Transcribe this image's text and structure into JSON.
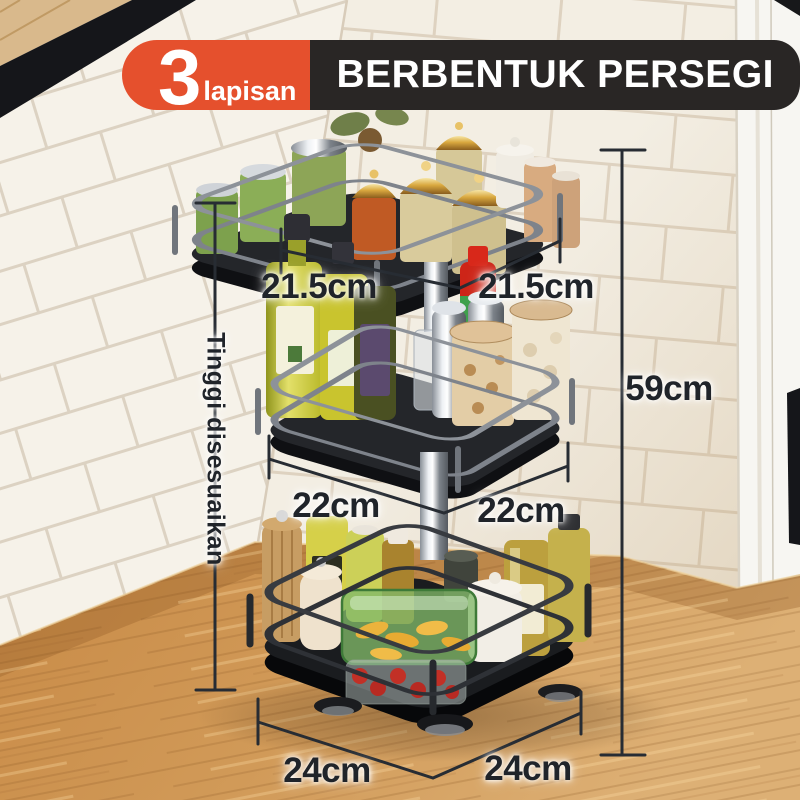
{
  "badge": {
    "count": "3",
    "count_label": "lapisan",
    "title": "BERBENTUK PERSEGI",
    "accent_color": "#e5502d",
    "bar_color": "#292625"
  },
  "dimensions": {
    "tiers": [
      {
        "name": "tier-atas",
        "left": "21.5cm",
        "right": "21.5cm"
      },
      {
        "name": "tier-tengah",
        "left": "22cm",
        "right": "22cm"
      },
      {
        "name": "tier-bawah",
        "left": "24cm",
        "right": "24cm"
      }
    ],
    "total_height": "59cm",
    "adjustable_height_note": "Tinggi disesuaikan"
  }
}
